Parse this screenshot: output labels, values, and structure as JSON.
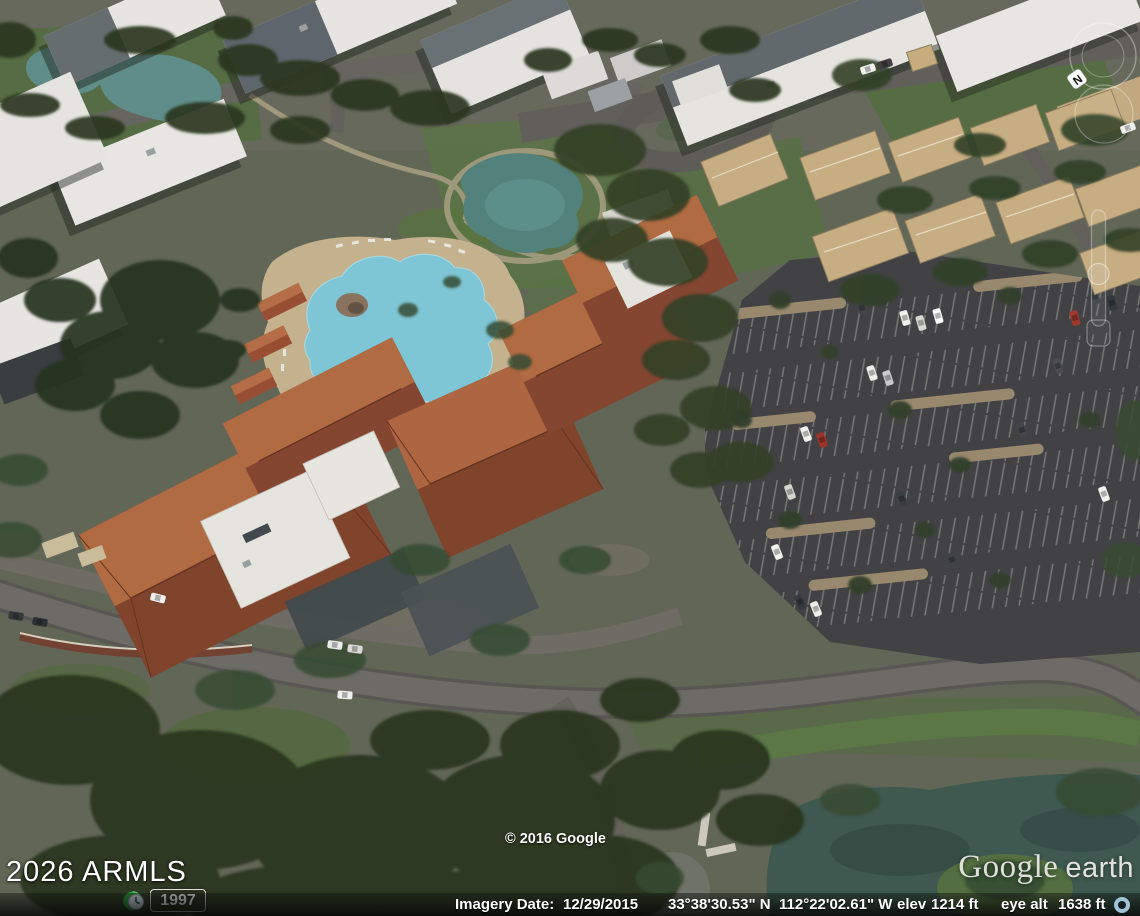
{
  "overlays": {
    "mls_watermark": "2026 ARMLS",
    "copyright": "© 2016 Google",
    "time_slider": {
      "year": "1997",
      "icon": "historical-imagery-clock-icon"
    }
  },
  "logo": {
    "google": "Google",
    "earth": "earth"
  },
  "status_bar": {
    "imagery_date_label": "Imagery Date:",
    "imagery_date": "12/29/2015",
    "latitude": "33°38'30.53\" N",
    "longitude": "112°22'02.61\" W",
    "elev_label": "elev",
    "elevation": "1214 ft",
    "eye_alt_label": "eye alt",
    "eye_altitude": "1638 ft",
    "streaming_icon": "streaming-progress-icon"
  },
  "nav_controls": {
    "compass_north_label": "N",
    "items": [
      "compass-icon",
      "look-joystick-icon",
      "zoom-slider-icon"
    ]
  },
  "colors": {
    "pool": "#7cc7d6",
    "roof_terracotta": "#8a4527",
    "lake": "#39544a",
    "status_text": "#ffffff",
    "streaming_ring": "#9fc2d6"
  }
}
